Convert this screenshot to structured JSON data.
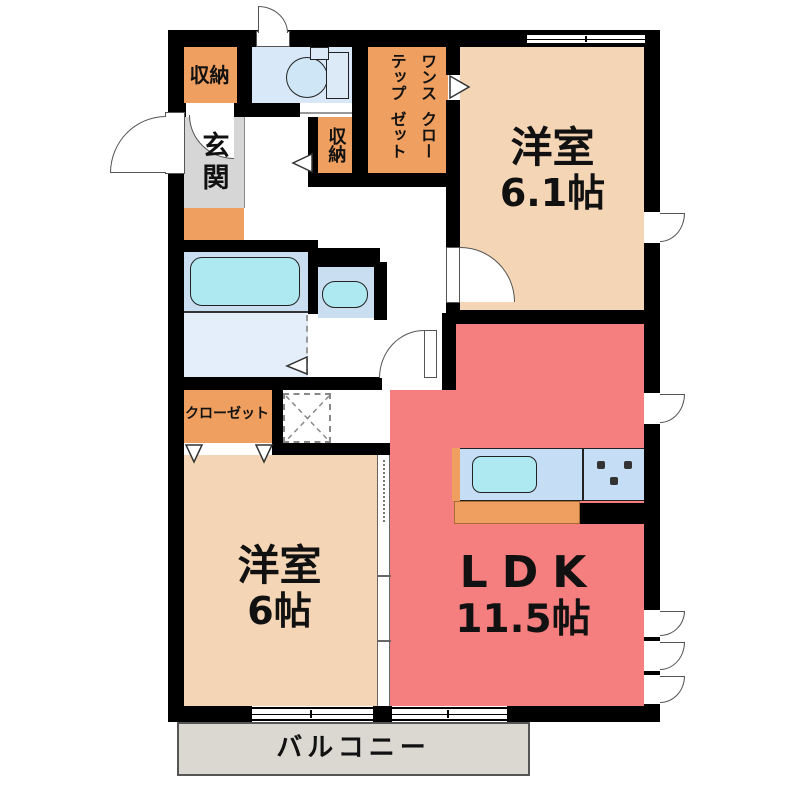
{
  "colors": {
    "wall": "#000000",
    "bedroom_peach": "#f4d5b5",
    "ldk_red": "#f57e7e",
    "storage_orange": "#ef9f60",
    "toilet_blue": "#d8e8f8",
    "bath_blue": "#c9def1",
    "washroom_blue": "#e4eefa",
    "counter_blue": "#c5def5",
    "fixture_cyan": "#aee9f2",
    "genkan_gray": "#d6d6d6",
    "balcony_gray": "#dbd8d2"
  },
  "rooms": {
    "western_top": {
      "name": "洋室",
      "size": "6.1帖"
    },
    "ldk": {
      "name": "LDK",
      "size": "11.5帖"
    },
    "western_bottom": {
      "name": "洋室",
      "size": "6帖"
    }
  },
  "labels": {
    "genkan": "玄関",
    "storage_top": "収納",
    "storage_hall": "収納",
    "wic_col_right": "ワンステップ",
    "wic_col_left": "クローゼット",
    "closet": "クローゼット",
    "balcony": "バルコニー"
  }
}
